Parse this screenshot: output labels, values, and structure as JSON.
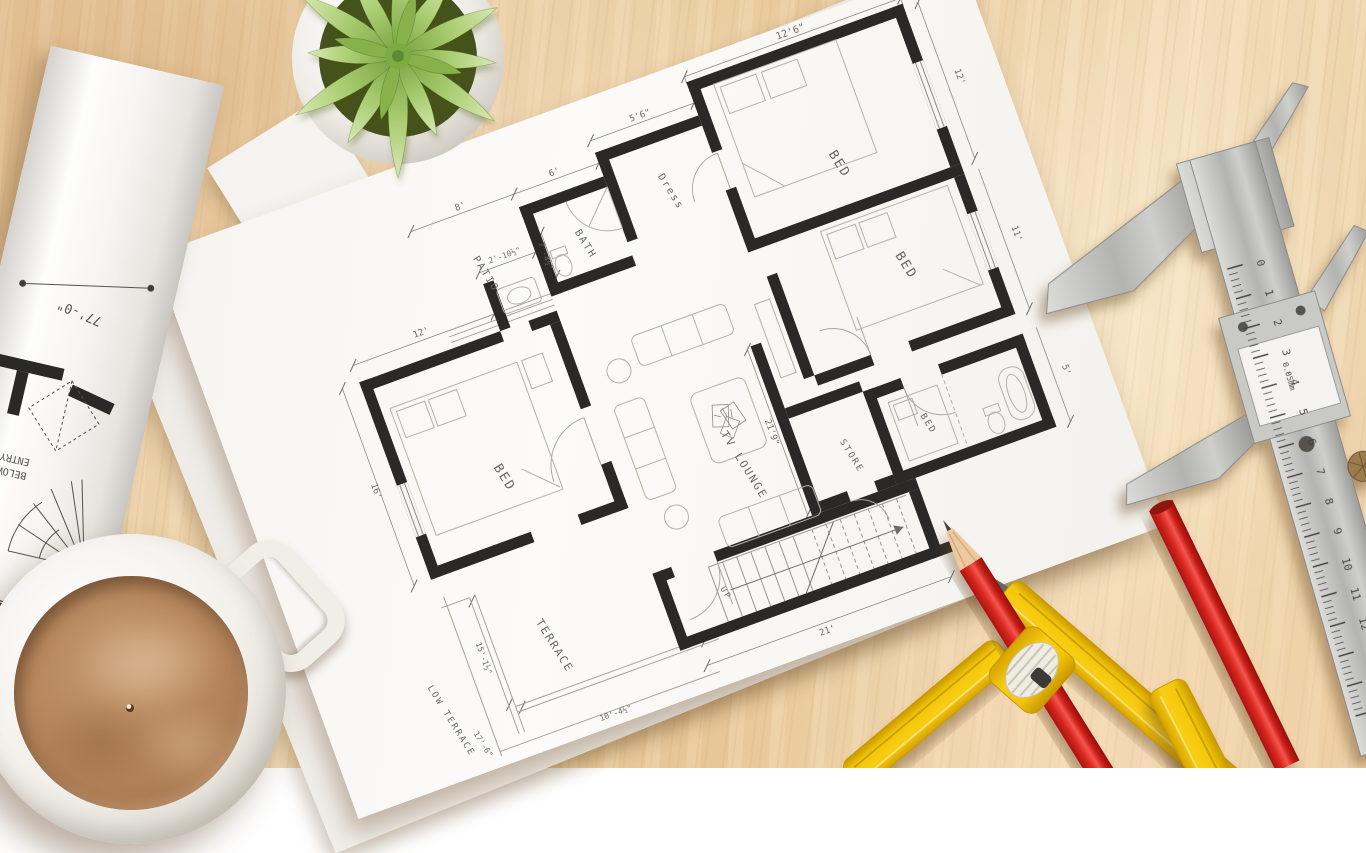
{
  "colors": {
    "wood": "#e9cda2",
    "paper": "#fbfaf8",
    "wall_ink": "#2b2927",
    "pencil_red": "#cf1f17",
    "compass_yellow": "#f4c60a",
    "leaf_green": "#85b548",
    "coffee_brown": "#b8885e",
    "caliper_metal": "#c4c4c1"
  },
  "plan": {
    "labels": [
      {
        "text": "BED",
        "x": 672,
        "y": 150,
        "rot": 78,
        "size": 13
      },
      {
        "text": "Dress",
        "x": 505,
        "y": 118,
        "rot": 78,
        "size": 10
      },
      {
        "text": "BATH",
        "x": 407,
        "y": 138,
        "rot": 78,
        "size": 10
      },
      {
        "text": "PATIO",
        "x": 303,
        "y": 132,
        "rot": 78,
        "size": 10
      },
      {
        "text": "BED",
        "x": 250,
        "y": 330,
        "rot": 78,
        "size": 13
      },
      {
        "text": "TV LOUNGE",
        "x": 480,
        "y": 400,
        "rot": 78,
        "size": 11
      },
      {
        "text": "BED",
        "x": 700,
        "y": 268,
        "rot": 78,
        "size": 13
      },
      {
        "text": "BED",
        "x": 668,
        "y": 424,
        "rot": 78,
        "size": 9
      },
      {
        "text": "STORE",
        "x": 585,
        "y": 428,
        "rot": 78,
        "size": 9
      },
      {
        "text": "TERRACE",
        "x": 240,
        "y": 505,
        "rot": 78,
        "size": 11
      },
      {
        "text": "UP",
        "x": 420,
        "y": 514,
        "rot": 78,
        "size": 8
      },
      {
        "text": "LOW TERRACE",
        "x": 118,
        "y": 540,
        "rot": 78,
        "size": 9
      }
    ],
    "dims": [
      {
        "text": "12'6\"",
        "x": 675,
        "y": 11,
        "rot": 0,
        "size": 10
      },
      {
        "text": "12'",
        "x": 816,
        "y": 108,
        "rot": 90,
        "size": 9
      },
      {
        "text": "5'6\"",
        "x": 505,
        "y": 38,
        "rot": 0,
        "size": 9
      },
      {
        "text": "6'",
        "x": 405,
        "y": 62,
        "rot": 0,
        "size": 9
      },
      {
        "text": "8'",
        "x": 305,
        "y": 62,
        "rot": 0,
        "size": 9
      },
      {
        "text": "2'-10½\"",
        "x": 330,
        "y": 123,
        "rot": 0,
        "size": 8
      },
      {
        "text": "7'-4½\"",
        "x": 366,
        "y": 135,
        "rot": 90,
        "size": 8
      },
      {
        "text": "12'",
        "x": 225,
        "y": 167,
        "rot": 0,
        "size": 9
      },
      {
        "text": "16'",
        "x": 126,
        "y": 298,
        "rot": 90,
        "size": 9
      },
      {
        "text": "11'",
        "x": 816,
        "y": 275,
        "rot": 90,
        "size": 9
      },
      {
        "text": "5'",
        "x": 816,
        "y": 420,
        "rot": 90,
        "size": 9
      },
      {
        "text": "21'9\"",
        "x": 518,
        "y": 378,
        "rot": 90,
        "size": 9
      },
      {
        "text": "21'",
        "x": 505,
        "y": 586,
        "rot": 0,
        "size": 9
      },
      {
        "text": "15'-1½\"",
        "x": 170,
        "y": 492,
        "rot": 90,
        "size": 8
      },
      {
        "text": "10'-4½\"",
        "x": 278,
        "y": 591,
        "rot": 0,
        "size": 8
      },
      {
        "text": "17'-6\"",
        "x": 140,
        "y": 573,
        "rot": 78,
        "size": 8
      }
    ]
  },
  "roll": {
    "dim": "77'-0\"",
    "entry_line1": "ENTRY",
    "entry_line2": "BELOW"
  },
  "caliper": {
    "scale_numbers": [
      "0",
      "1",
      "2",
      "3",
      "4",
      "5",
      "6",
      "7",
      "8",
      "9",
      "10",
      "11",
      "12",
      "13",
      "14",
      "15"
    ],
    "unit": "cm",
    "precision": "0.05mm"
  }
}
